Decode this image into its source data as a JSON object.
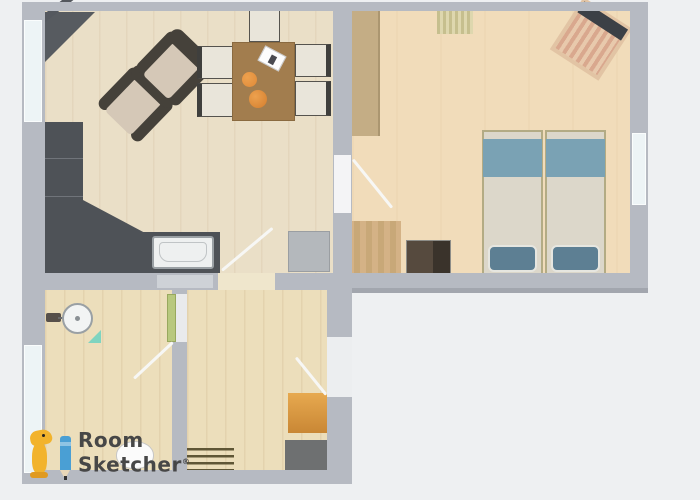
{
  "document": {
    "type": "2D floor plan rendering",
    "brand": "RoomSketcher"
  },
  "logo": {
    "line1": "Room",
    "line2": "Sketcher",
    "reg": "®"
  },
  "palette": {
    "bg": "#eef0f2",
    "wall": "#b6bac2",
    "wall-dark": "#a2a6ae",
    "floor-living": "#eadfc7",
    "floor-bed": "#f1dcba",
    "floor-bath": "#ecdebb",
    "counter": "#4e5257",
    "chair-frame": "#45413a",
    "chair-cushion": "#d5c8b7",
    "table": "#a27d4e",
    "orange": "#e08a38",
    "wardrobe": "#c4ad85",
    "bed-frame": "#b3ab84",
    "bed-blanket": "#7aa2b4",
    "bed-duvet": "#dcd7ca",
    "bed-pillow": "#5d7f93",
    "nightstand": "#564a3e",
    "wood": "#d4b286",
    "mat-orange": "#dfa04a",
    "mat-dark": "#6e7071",
    "window": "#edf4f6",
    "door-green": "#b8c87e",
    "teal": "#7fd4c0",
    "logo-yellow": "#f2b32c",
    "logo-blue": "#4a9fd4",
    "logo-text": "#474747"
  },
  "plan": {
    "rooms": [
      {
        "name": "living-room-kitchen",
        "furniture": [
          "corner-cabinet",
          "corner-shelf-bar",
          "l-shaped-kitchen-counter",
          "kitchen-sink",
          "stove",
          "armchair",
          "armchair",
          "dining-table",
          "dining-chair",
          "dining-chair",
          "dining-chair",
          "dining-chair",
          "dining-chair",
          "oranges",
          "paper-sheet"
        ],
        "openings": [
          "window-left",
          "door-to-hallway",
          "door-to-bedroom"
        ]
      },
      {
        "name": "bedroom",
        "furniture": [
          "wardrobe",
          "striped-rug",
          "crib",
          "single-bed",
          "single-bed",
          "nightstand",
          "wood-mat"
        ],
        "openings": [
          "door-to-living-room",
          "window-right"
        ]
      },
      {
        "name": "bathroom",
        "furniture": [
          "round-sink",
          "faucet",
          "teal-shelf",
          "toilet"
        ],
        "openings": [
          "window-left",
          "green-door"
        ]
      },
      {
        "name": "hallway",
        "furniture": [
          "striped-doormat",
          "orange-mat",
          "dark-gray-mat",
          "standing-figure"
        ],
        "openings": [
          "entrance-door"
        ]
      }
    ]
  }
}
